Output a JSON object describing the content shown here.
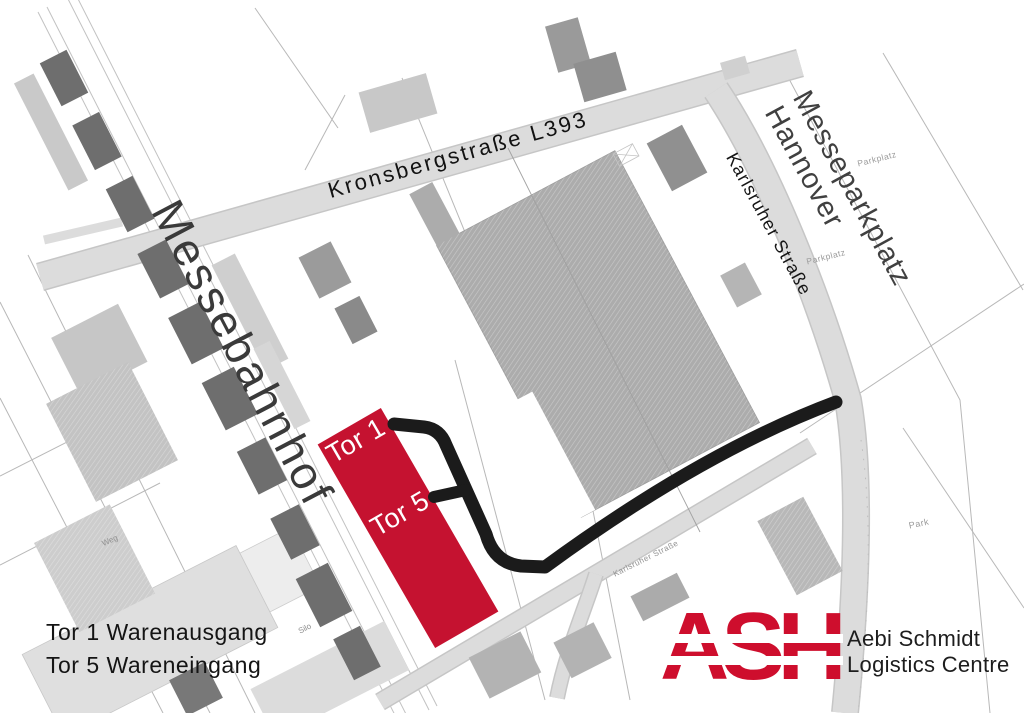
{
  "map": {
    "streets": {
      "kronsbergstrasse": "Kronsbergstraße L393",
      "karlsruher_strasse": "Karlsruher Straße",
      "karlsruher_strasse_small": "Karlsruher Straße",
      "messebahnhof": "Messebahnhof"
    },
    "areas": {
      "messeparkplatz_line1": "Messeparkplatz",
      "messeparkplatz_line2": "Hannover",
      "parkplatz_a": "Parkplatz",
      "parkplatz_b": "Parkplatz",
      "park": "Park",
      "silo": "Silo",
      "weg": "Weg"
    },
    "gates": {
      "tor1": "Tor 1",
      "tor5": "Tor 5"
    },
    "legend": {
      "line1": "Tor 1 Warenausgang",
      "line2": "Tor 5 Wareneingang"
    },
    "logo": {
      "letters": "ASH",
      "company_line1": "Aebi Schmidt",
      "company_line2": "Logistics Centre"
    },
    "colors": {
      "accent_red": "#C51230",
      "logo_red": "#CE0E2D",
      "route_black": "#1B1B1B",
      "road_gray": "#DCDCDC",
      "building_gray": "#ACACAC",
      "building_dark": "#6E6E6E"
    }
  }
}
